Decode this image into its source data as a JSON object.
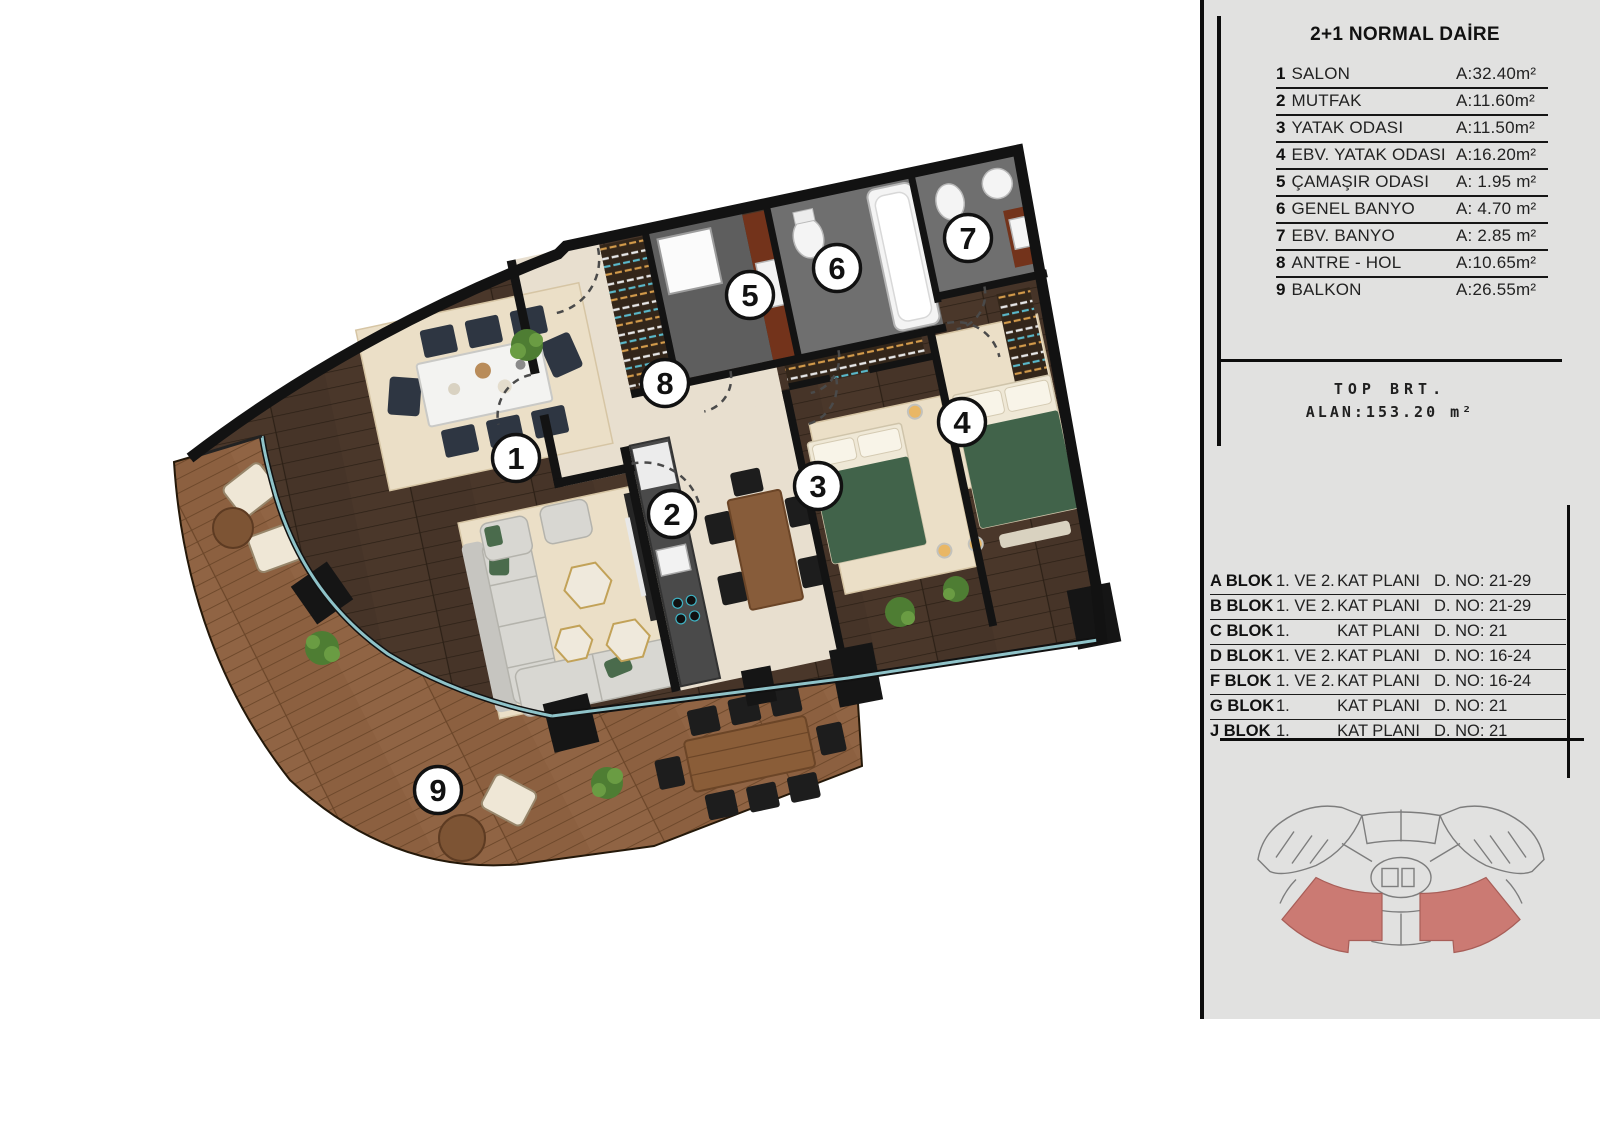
{
  "legend": {
    "title": "2+1 NORMAL DAİRE",
    "rooms": [
      {
        "num": "1",
        "name": "SALON",
        "area": "A:32.40m²"
      },
      {
        "num": "2",
        "name": "MUTFAK",
        "area": "A:11.60m²"
      },
      {
        "num": "3",
        "name": "YATAK ODASI",
        "area": "A:11.50m²"
      },
      {
        "num": "4",
        "name": "EBV. YATAK ODASI",
        "area": "A:16.20m²"
      },
      {
        "num": "5",
        "name": "ÇAMAŞIR ODASI",
        "area": "A: 1.95 m²"
      },
      {
        "num": "6",
        "name": "GENEL BANYO",
        "area": "A: 4.70 m²"
      },
      {
        "num": "7",
        "name": "EBV. BANYO",
        "area": "A: 2.85 m²"
      },
      {
        "num": "8",
        "name": "ANTRE - HOL",
        "area": "A:10.65m²"
      },
      {
        "num": "9",
        "name": "BALKON",
        "area": "A:26.55m²"
      }
    ],
    "total_label": "TOP BRT.",
    "total_value": "ALAN:153.20 m²"
  },
  "blocks": [
    {
      "block": "A BLOK",
      "floors": "1. VE 2.",
      "plan": "KAT PLANI",
      "no": "D. NO: 21-29"
    },
    {
      "block": "B BLOK",
      "floors": "1. VE 2.",
      "plan": "KAT PLANI",
      "no": "D. NO: 21-29"
    },
    {
      "block": "C BLOK",
      "floors": "1.",
      "plan": "KAT PLANI",
      "no": "D. NO: 21"
    },
    {
      "block": "D BLOK",
      "floors": "1. VE 2.",
      "plan": "KAT PLANI",
      "no": "D. NO: 16-24"
    },
    {
      "block": "F BLOK",
      "floors": "1. VE 2.",
      "plan": "KAT PLANI",
      "no": "D. NO: 16-24"
    },
    {
      "block": "G BLOK",
      "floors": "1.",
      "plan": "KAT PLANI",
      "no": "D. NO: 21"
    },
    {
      "block": "J BLOK",
      "floors": "1.",
      "plan": "KAT PLANI",
      "no": "D. NO: 21"
    }
  ],
  "plan": {
    "badges": [
      "1",
      "2",
      "3",
      "4",
      "5",
      "6",
      "7",
      "8",
      "9"
    ]
  },
  "colors": {
    "panel_bg": "#e1e1e0",
    "wall": "#111111",
    "glass": "#8fc3c9",
    "deck_wood": "#8c6040",
    "interior_wood": "#463428",
    "cream_floor": "#e8dfcf",
    "rug": "#ebdfc7",
    "bath_gray": "#6f6f6f",
    "bed_green": "#41634a",
    "highlight_red": "#cb7a73"
  }
}
